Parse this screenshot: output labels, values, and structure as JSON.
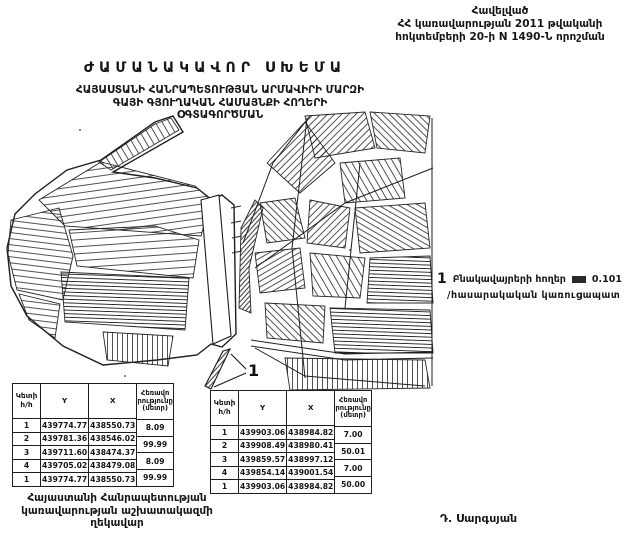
{
  "appendix": {
    "line1": "Հավելված",
    "line2": "ՀՀ կառավարության 2011 թվականի",
    "line3": "հոկտեմբերի 20-ի N 1490-Ն որոշման"
  },
  "title": "ԺԱՄԱՆԱԿԱՎՈՐ ՍԽԵՄԱ",
  "subtitle": {
    "line1": "ՀԱՅԱՍՏԱՆԻ ՀԱՆՐԱՊԵՏՈՒԹՅԱՆ ԱՐՄԱՎԻՐԻ ՄԱՐԶԻ",
    "line2": "ԳԱՅԻ ԳՅՈՒՂԱԿԱՆ ՀԱՄԱՅՆՔԻ ՀՈՂԵՐԻ",
    "line3": "ՕԳՏԱԳՈՐԾՄԱՆ"
  },
  "legend": {
    "marker": "1",
    "label": "Բնակավայրերի հողեր",
    "area": "0.101",
    "line2": "/հասարակական կառուցապատ"
  },
  "map": {
    "parcel_label": "1"
  },
  "tables": {
    "headers": {
      "point_line1": "Կետի",
      "point_line2": "հ/հ",
      "y": "Y",
      "x": "X",
      "dist_line1": "Հեռավո",
      "dist_line2": "րությունը",
      "dist_line3": "(մետր)"
    },
    "left": {
      "rows": [
        {
          "n": "1",
          "y": "439774.77",
          "x": "438550.73"
        },
        {
          "n": "2",
          "y": "439781.36",
          "x": "438546.02"
        },
        {
          "n": "3",
          "y": "439711.60",
          "x": "438474.37"
        },
        {
          "n": "4",
          "y": "439705.02",
          "x": "438479.08"
        },
        {
          "n": "1",
          "y": "439774.77",
          "x": "438550.73"
        }
      ],
      "dists": [
        "8.09",
        "99.99",
        "8.09",
        "99.99"
      ]
    },
    "right": {
      "rows": [
        {
          "n": "1",
          "y": "439903.06",
          "x": "438984.82"
        },
        {
          "n": "2",
          "y": "439908.49",
          "x": "438980.41"
        },
        {
          "n": "3",
          "y": "439859.57",
          "x": "438997.12"
        },
        {
          "n": "4",
          "y": "439854.14",
          "x": "439001.54"
        },
        {
          "n": "1",
          "y": "439903.06",
          "x": "438984.82"
        }
      ],
      "dists": [
        "7.00",
        "50.01",
        "7.00",
        "50.00"
      ]
    }
  },
  "signature": {
    "line1": "Հայաստանի Հանրապետության",
    "line2": "կառավարության աշխատակազմի",
    "line3": "ղեկավար",
    "name": "Դ. Սարգսյան"
  }
}
